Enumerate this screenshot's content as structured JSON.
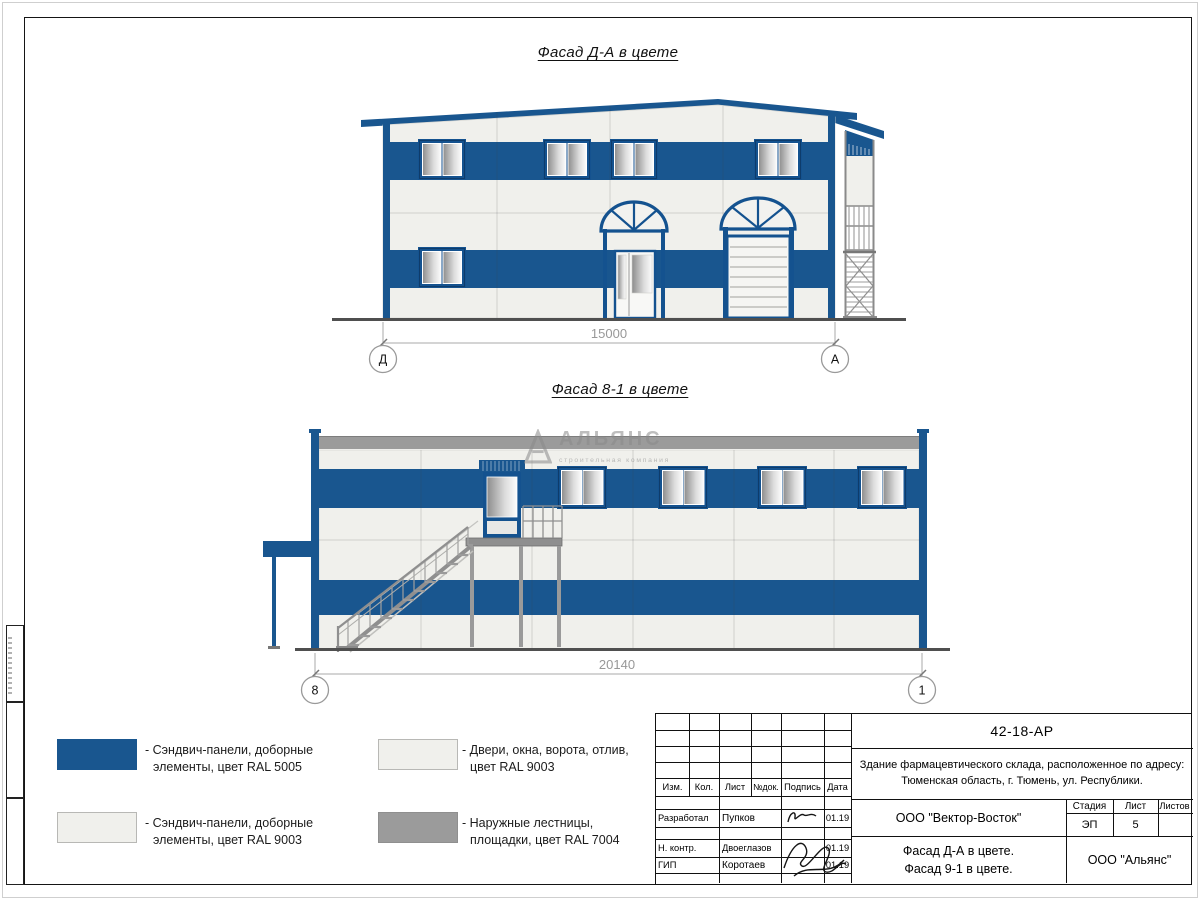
{
  "sheet": {
    "facades": {
      "da": {
        "title": "Фасад Д-А в цвете",
        "dimension": "15000",
        "axis_left": "Д",
        "axis_right": "А"
      },
      "v81": {
        "title": "Фасад 8-1 в цвете",
        "dimension": "20140",
        "axis_left": "8",
        "axis_right": "1"
      }
    },
    "watermark": {
      "name": "АЛЬЯНС",
      "tagline": "строительная компания"
    },
    "colors": {
      "panel_blue": "#19568F",
      "panel_white": "#F0F0EC",
      "metal_gray": "#9B9B9B"
    },
    "legend": {
      "items": [
        {
          "color": "#19568F",
          "line1": "- Сэндвич-панели, доборные",
          "line2": "элементы, цвет RAL 5005"
        },
        {
          "color": "#F0F0EC",
          "line1": "- Сэндвич-панели, доборные",
          "line2": "элементы, цвет RAL 9003"
        },
        {
          "color": "#F0F0EC",
          "line1": "- Двери, окна, ворота, отлив,",
          "line2": "цвет RAL 9003"
        },
        {
          "color": "#9B9B9B",
          "line1": "- Наружные лестницы,",
          "line2": "площадки, цвет RAL 7004"
        }
      ]
    },
    "titleblock": {
      "code": "42-18-АР",
      "address_line1": "Здание фармацевтического склада, расположенное по адресу:",
      "address_line2": "Тюменская область, г. Тюмень, ул. Республики.",
      "cols": {
        "izm": "Изм.",
        "kol": "Кол.",
        "list": "Лист",
        "ndok": "№док.",
        "podpis": "Подпись",
        "data": "Дата"
      },
      "rows": [
        {
          "role": "Разработал",
          "name": "Пупков",
          "date": "01.19"
        },
        {
          "role": "Н. контр.",
          "name": "Двоеглазов",
          "date": "01.19"
        },
        {
          "role": "ГИП",
          "name": "Коротаев",
          "date": "01.19"
        }
      ],
      "company": "ООО \"Вектор-Восток\"",
      "stage_label": "Стадия",
      "sheet_label": "Лист",
      "sheets_label": "Листов",
      "stage": "ЭП",
      "sheet_num": "5",
      "sheets_total": "",
      "drawing_title_line1": "Фасад Д-А в цвете.",
      "drawing_title_line2": "Фасад 9-1 в цвете.",
      "org": "ООО \"Альянс\""
    }
  }
}
